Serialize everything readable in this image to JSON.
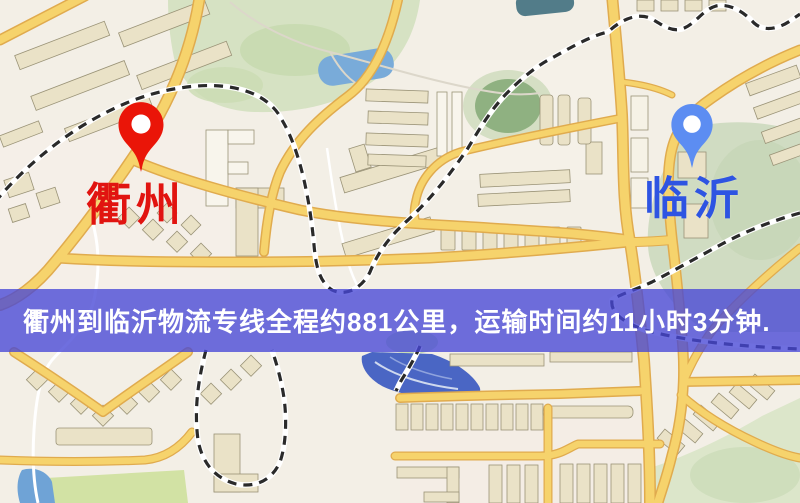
{
  "banner": {
    "text": "衢州到临沂物流专线全程约881公里，运输时间约11小时3分钟.",
    "bg_color": "rgba(70,70,214,0.78)",
    "text_color": "#ffffff"
  },
  "route": {
    "origin": "衢州",
    "destination": "临沂",
    "distance_text": "约881公里",
    "duration_text": "约11小时3分钟"
  },
  "markers": [
    {
      "id": "quzhou",
      "label": "衢州",
      "label_color": "#e11410",
      "pin_color": "#ea1508",
      "icon": "map-pin-icon"
    },
    {
      "id": "linyi",
      "label": "临沂",
      "label_color": "#2e54e2",
      "pin_color": "#5c8df2",
      "icon": "map-pin-icon"
    }
  ],
  "map_colors": {
    "background": "#f3efe6",
    "road_fill": "#f6d26b",
    "road_casing": "#e0ab4e",
    "park_green": "#d6e2c3",
    "dark_green": "#8fb181",
    "water_blue": "#79abd9",
    "deep_water_blue": "#4a66c4",
    "building_tan": "#eae2c7",
    "railway_dark": "#2a2a2a"
  }
}
